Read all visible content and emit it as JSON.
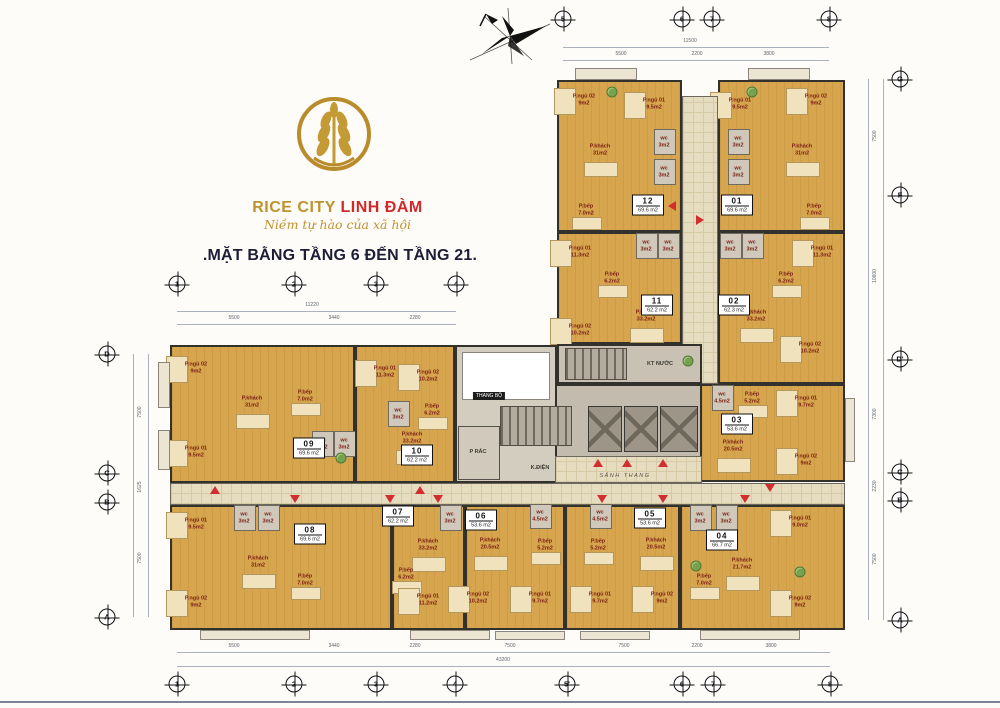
{
  "branding": {
    "brand_primary": "RICE CITY",
    "brand_secondary": "LINH ĐÀM",
    "tagline": "Niềm tự hào của xã hội",
    "title": ".MẶT BẰNG TẦNG 6 ĐẾN TẦNG 21.",
    "colors": {
      "gold": "#bf922d",
      "red": "#d3282a",
      "title": "#1d1d36"
    }
  },
  "plan": {
    "blocks": [
      {
        "kind": "corr",
        "x": 682,
        "y": 96,
        "w": 36,
        "h": 288
      },
      {
        "kind": "tech",
        "x": 557,
        "y": 344,
        "w": 145,
        "h": 40
      },
      {
        "kind": "junction",
        "x": 455,
        "y": 345,
        "w": 102,
        "h": 138
      },
      {
        "kind": "core",
        "x": 555,
        "y": 384,
        "w": 147,
        "h": 99
      },
      {
        "kind": "corr",
        "x": 170,
        "y": 483,
        "w": 675,
        "h": 22
      },
      {
        "kind": "corr",
        "x": 555,
        "y": 456,
        "w": 147,
        "h": 27
      },
      {
        "kind": "void",
        "x": 462,
        "y": 352,
        "w": 88,
        "h": 48
      },
      {
        "kind": "stairs",
        "x": 500,
        "y": 406,
        "w": 72,
        "h": 40
      },
      {
        "kind": "stairs",
        "x": 565,
        "y": 348,
        "w": 62,
        "h": 32
      },
      {
        "kind": "room",
        "x": 458,
        "y": 426,
        "w": 42,
        "h": 54
      },
      {
        "kind": "lift",
        "x": 588,
        "y": 406,
        "w": 34,
        "h": 46
      },
      {
        "kind": "lift",
        "x": 624,
        "y": 406,
        "w": 34,
        "h": 46
      },
      {
        "kind": "lift",
        "x": 660,
        "y": 406,
        "w": 38,
        "h": 46
      },
      {
        "kind": "bal",
        "x": 575,
        "y": 68,
        "w": 62,
        "h": 12
      },
      {
        "kind": "bal",
        "x": 748,
        "y": 68,
        "w": 62,
        "h": 12
      },
      {
        "kind": "bal",
        "x": 158,
        "y": 362,
        "w": 12,
        "h": 46
      },
      {
        "kind": "bal",
        "x": 158,
        "y": 430,
        "w": 12,
        "h": 40
      },
      {
        "kind": "bal",
        "x": 845,
        "y": 398,
        "w": 10,
        "h": 64
      },
      {
        "kind": "bal",
        "x": 200,
        "y": 630,
        "w": 110,
        "h": 10
      },
      {
        "kind": "bal",
        "x": 410,
        "y": 630,
        "w": 80,
        "h": 10
      },
      {
        "kind": "bal",
        "x": 495,
        "y": 631,
        "w": 70,
        "h": 9
      },
      {
        "kind": "bal",
        "x": 580,
        "y": 631,
        "w": 70,
        "h": 9
      },
      {
        "kind": "bal",
        "x": 700,
        "y": 630,
        "w": 100,
        "h": 10
      }
    ],
    "apartments": [
      {
        "id": "12",
        "area": "69.6 m2",
        "rect": [
          557,
          80,
          125,
          152
        ],
        "chip": [
          648,
          205
        ],
        "rooms": [
          [
            "P.ngủ 02",
            "9m2",
            584,
            100
          ],
          [
            "P.ngủ 01",
            "9.5m2",
            654,
            104
          ],
          [
            "wc",
            "3m2",
            664,
            142
          ],
          [
            "wc",
            "3m2",
            664,
            172
          ],
          [
            "P.khách",
            "31m2",
            600,
            150
          ],
          [
            "P.bếp",
            "7.0m2",
            586,
            210
          ]
        ]
      },
      {
        "id": "01",
        "area": "69.6 m2",
        "rect": [
          718,
          80,
          127,
          152
        ],
        "chip": [
          737,
          205
        ],
        "rooms": [
          [
            "P.ngủ 01",
            "9.5m2",
            740,
            104
          ],
          [
            "P.ngủ 02",
            "9m2",
            816,
            100
          ],
          [
            "wc",
            "3m2",
            738,
            142
          ],
          [
            "wc",
            "3m2",
            738,
            172
          ],
          [
            "P.khách",
            "31m2",
            802,
            150
          ],
          [
            "P.bếp",
            "7.0m2",
            814,
            210
          ]
        ]
      },
      {
        "id": "11",
        "area": "62.2 m2",
        "rect": [
          557,
          232,
          125,
          112
        ],
        "chip": [
          657,
          305
        ],
        "rooms": [
          [
            "P.ngủ 01",
            "11.3m2",
            580,
            252
          ],
          [
            "wc",
            "3m2",
            646,
            246
          ],
          [
            "wc",
            "3m2",
            668,
            246
          ],
          [
            "P.bếp",
            "6.2m2",
            612,
            278
          ],
          [
            "P.khách",
            "33.2m2",
            646,
            316
          ],
          [
            "P.ngủ 02",
            "10.2m2",
            580,
            330
          ]
        ]
      },
      {
        "id": "02",
        "area": "62.3 m2",
        "rect": [
          718,
          232,
          127,
          152
        ],
        "chip": [
          734,
          305
        ],
        "rooms": [
          [
            "P.ngủ 01",
            "11.3m2",
            822,
            252
          ],
          [
            "wc",
            "3m2",
            730,
            246
          ],
          [
            "wc",
            "3m2",
            752,
            246
          ],
          [
            "P.bếp",
            "6.2m2",
            786,
            278
          ],
          [
            "P.khách",
            "33.2m2",
            756,
            316
          ],
          [
            "P.ngủ 02",
            "10.2m2",
            810,
            348
          ]
        ]
      },
      {
        "id": "03",
        "area": "53.6 m2",
        "rect": [
          700,
          384,
          145,
          98
        ],
        "chip": [
          737,
          424
        ],
        "rooms": [
          [
            "wc",
            "4.5m2",
            722,
            398
          ],
          [
            "P.bếp",
            "5.2m2",
            752,
            398
          ],
          [
            "P.ngủ 01",
            "9.7m2",
            806,
            402
          ],
          [
            "P.khách",
            "20.5m2",
            733,
            446
          ],
          [
            "P.ngủ 02",
            "9m2",
            806,
            460
          ]
        ]
      },
      {
        "id": "09",
        "area": "69.6 m2",
        "rect": [
          170,
          345,
          185,
          138
        ],
        "chip": [
          309,
          448
        ],
        "rooms": [
          [
            "P.ngủ 02",
            "9m2",
            196,
            368
          ],
          [
            "P.khách",
            "31m2",
            252,
            402
          ],
          [
            "P.bếp",
            "7.0m2",
            305,
            396
          ],
          [
            "P.ngủ 01",
            "9.5m2",
            196,
            452
          ],
          [
            "wc",
            "3m2",
            322,
            444
          ],
          [
            "wc",
            "3m2",
            344,
            444
          ]
        ]
      },
      {
        "id": "10",
        "area": "62.2 m2",
        "rect": [
          355,
          345,
          100,
          138
        ],
        "chip": [
          417,
          455
        ],
        "rooms": [
          [
            "P.ngủ 01",
            "11.3m2",
            385,
            372
          ],
          [
            "P.ngủ 02",
            "10.2m2",
            428,
            376
          ],
          [
            "wc",
            "3m2",
            398,
            414
          ],
          [
            "P.bếp",
            "6.2m2",
            432,
            410
          ],
          [
            "P.khách",
            "33.2m2",
            412,
            438
          ]
        ]
      },
      {
        "id": "08",
        "area": "69.6 m2",
        "rect": [
          170,
          505,
          222,
          125
        ],
        "chip": [
          310,
          534
        ],
        "rooms": [
          [
            "P.ngủ 01",
            "9.5m2",
            196,
            524
          ],
          [
            "wc",
            "3m2",
            244,
            518
          ],
          [
            "wc",
            "3m2",
            268,
            518
          ],
          [
            "P.khách",
            "31m2",
            258,
            562
          ],
          [
            "P.bếp",
            "7.0m2",
            305,
            580
          ],
          [
            "P.ngủ 02",
            "9m2",
            196,
            602
          ]
        ]
      },
      {
        "id": "07",
        "area": "62.2 m2",
        "rect": [
          392,
          505,
          73,
          125
        ],
        "chip": [
          398,
          516
        ],
        "rooms": [
          [
            "wc",
            "3m2",
            450,
            518
          ],
          [
            "P.khách",
            "33.2m2",
            428,
            545
          ],
          [
            "P.bếp",
            "6.2m2",
            406,
            574
          ],
          [
            "P.ngủ 01",
            "11.2m2",
            428,
            600
          ]
        ]
      },
      {
        "id": "06",
        "area": "53.6 m2",
        "rect": [
          465,
          505,
          100,
          125
        ],
        "chip": [
          481,
          520
        ],
        "rooms": [
          [
            "wc",
            "4.5m2",
            540,
            516
          ],
          [
            "P.khách",
            "20.5m2",
            490,
            544
          ],
          [
            "P.bếp",
            "5.2m2",
            545,
            545
          ],
          [
            "P.ngủ 02",
            "10.2m2",
            478,
            598
          ],
          [
            "P.ngủ 01",
            "9.7m2",
            540,
            598
          ]
        ]
      },
      {
        "id": "05",
        "area": "53.6 m2",
        "rect": [
          565,
          505,
          115,
          125
        ],
        "chip": [
          650,
          518
        ],
        "rooms": [
          [
            "wc",
            "4.5m2",
            600,
            516
          ],
          [
            "P.khách",
            "20.5m2",
            656,
            544
          ],
          [
            "P.bếp",
            "5.2m2",
            598,
            545
          ],
          [
            "P.ngủ 01",
            "9.7m2",
            600,
            598
          ],
          [
            "P.ngủ 02",
            "9m2",
            662,
            598
          ]
        ]
      },
      {
        "id": "04",
        "area": "66.7 m2",
        "rect": [
          680,
          505,
          165,
          125
        ],
        "chip": [
          722,
          540
        ],
        "rooms": [
          [
            "wc",
            "3m2",
            700,
            518
          ],
          [
            "wc",
            "3m2",
            726,
            518
          ],
          [
            "P.ngủ 01",
            "9.0m2",
            800,
            522
          ],
          [
            "P.khách",
            "21.7m2",
            742,
            564
          ],
          [
            "P.bếp",
            "7.0m2",
            704,
            580
          ],
          [
            "P.ngủ 02",
            "9m2",
            800,
            602
          ]
        ]
      }
    ],
    "core_labels": [
      {
        "t": "THANG BỘ",
        "x": 489,
        "y": 396,
        "k": "chipk"
      },
      {
        "t": "P RÁC",
        "x": 478,
        "y": 452,
        "k": "txt"
      },
      {
        "t": "K.ĐIỆN",
        "x": 540,
        "y": 468,
        "k": "txt"
      },
      {
        "t": "KT NƯỚC",
        "x": 660,
        "y": 364,
        "k": "txt"
      },
      {
        "t": "SẢNH THANG",
        "x": 625,
        "y": 476,
        "k": "it"
      }
    ],
    "axes": [
      {
        "o": "h",
        "y": 19,
        "items": [
          {
            "n": "5",
            "x": 563
          },
          {
            "n": "6",
            "x": 682
          },
          {
            "n": "7",
            "x": 712
          },
          {
            "n": "8",
            "x": 829
          }
        ]
      },
      {
        "o": "h",
        "y": 284,
        "items": [
          {
            "n": "1",
            "x": 177
          },
          {
            "n": "2",
            "x": 294
          },
          {
            "n": "3",
            "x": 376
          },
          {
            "n": "4",
            "x": 456
          }
        ]
      },
      {
        "o": "h",
        "y": 684,
        "items": [
          {
            "n": "1",
            "x": 177
          },
          {
            "n": "2",
            "x": 294
          },
          {
            "n": "3",
            "x": 376
          },
          {
            "n": "4",
            "x": 455
          },
          {
            "n": "5'",
            "x": 567
          },
          {
            "n": "6",
            "x": 682
          },
          {
            "n": "7",
            "x": 713
          },
          {
            "n": "8",
            "x": 830
          }
        ]
      },
      {
        "o": "v",
        "x": 107,
        "items": [
          {
            "n": "D",
            "y": 354
          },
          {
            "n": "C",
            "y": 473
          },
          {
            "n": "B",
            "y": 502
          },
          {
            "n": "A",
            "y": 617
          }
        ]
      },
      {
        "o": "v",
        "x": 900,
        "items": [
          {
            "n": "G",
            "y": 79
          },
          {
            "n": "F",
            "y": 195
          },
          {
            "n": "D'",
            "y": 359
          },
          {
            "n": "C",
            "y": 472
          },
          {
            "n": "B",
            "y": 500
          },
          {
            "n": "A",
            "y": 620
          }
        ]
      }
    ],
    "dim_lines": [
      {
        "x": 563,
        "y": 47,
        "w": 266
      },
      {
        "x": 563,
        "y": 60,
        "w": 266
      },
      {
        "x": 177,
        "y": 311,
        "w": 279
      },
      {
        "x": 177,
        "y": 324,
        "w": 279
      },
      {
        "x": 177,
        "y": 652,
        "w": 653
      },
      {
        "x": 177,
        "y": 666,
        "w": 653
      },
      {
        "x": 133,
        "y": 354,
        "h": 263
      },
      {
        "x": 148,
        "y": 354,
        "h": 263
      },
      {
        "x": 868,
        "y": 79,
        "h": 541
      },
      {
        "x": 883,
        "y": 79,
        "h": 541
      }
    ],
    "dim_labels": [
      {
        "t": "11500",
        "x": 690,
        "y": 41
      },
      {
        "t": "5500",
        "x": 621,
        "y": 54
      },
      {
        "t": "2200",
        "x": 697,
        "y": 54
      },
      {
        "t": "3800",
        "x": 769,
        "y": 54
      },
      {
        "t": "11220",
        "x": 312,
        "y": 305
      },
      {
        "t": "5500",
        "x": 234,
        "y": 318
      },
      {
        "t": "3440",
        "x": 334,
        "y": 318
      },
      {
        "t": "2280",
        "x": 415,
        "y": 318
      },
      {
        "t": "5500",
        "x": 234,
        "y": 646
      },
      {
        "t": "3440",
        "x": 334,
        "y": 646
      },
      {
        "t": "2280",
        "x": 415,
        "y": 646
      },
      {
        "t": "7500",
        "x": 510,
        "y": 646
      },
      {
        "t": "7500",
        "x": 624,
        "y": 646
      },
      {
        "t": "2200",
        "x": 697,
        "y": 646
      },
      {
        "t": "3800",
        "x": 771,
        "y": 646
      },
      {
        "t": "43200",
        "x": 503,
        "y": 660
      },
      {
        "t": "7500",
        "x": 140,
        "y": 412,
        "v": 1
      },
      {
        "t": "1625",
        "x": 140,
        "y": 487,
        "v": 1
      },
      {
        "t": "7500",
        "x": 140,
        "y": 558,
        "v": 1
      },
      {
        "t": "7500",
        "x": 875,
        "y": 136,
        "v": 1
      },
      {
        "t": "10600",
        "x": 875,
        "y": 276,
        "v": 1
      },
      {
        "t": "7300",
        "x": 875,
        "y": 414,
        "v": 1
      },
      {
        "t": "2230",
        "x": 875,
        "y": 486,
        "v": 1
      },
      {
        "t": "7500",
        "x": 875,
        "y": 559,
        "v": 1
      }
    ],
    "door_markers": [
      {
        "x": 672,
        "y": 206,
        "d": "left"
      },
      {
        "x": 700,
        "y": 220,
        "d": "right"
      },
      {
        "x": 598,
        "y": 463,
        "d": "up"
      },
      {
        "x": 627,
        "y": 463,
        "d": "up"
      },
      {
        "x": 663,
        "y": 463,
        "d": "up"
      },
      {
        "x": 215,
        "y": 490,
        "d": "up"
      },
      {
        "x": 420,
        "y": 490,
        "d": "up"
      },
      {
        "x": 295,
        "y": 499,
        "d": "down"
      },
      {
        "x": 390,
        "y": 499,
        "d": "down"
      },
      {
        "x": 438,
        "y": 499,
        "d": "down"
      },
      {
        "x": 602,
        "y": 499,
        "d": "down"
      },
      {
        "x": 663,
        "y": 499,
        "d": "down"
      },
      {
        "x": 745,
        "y": 499,
        "d": "down"
      },
      {
        "x": 770,
        "y": 488,
        "d": "down"
      }
    ],
    "plants": [
      [
        612,
        92
      ],
      [
        752,
        92
      ],
      [
        341,
        458
      ],
      [
        696,
        566
      ],
      [
        800,
        572
      ],
      [
        688,
        361
      ]
    ]
  }
}
